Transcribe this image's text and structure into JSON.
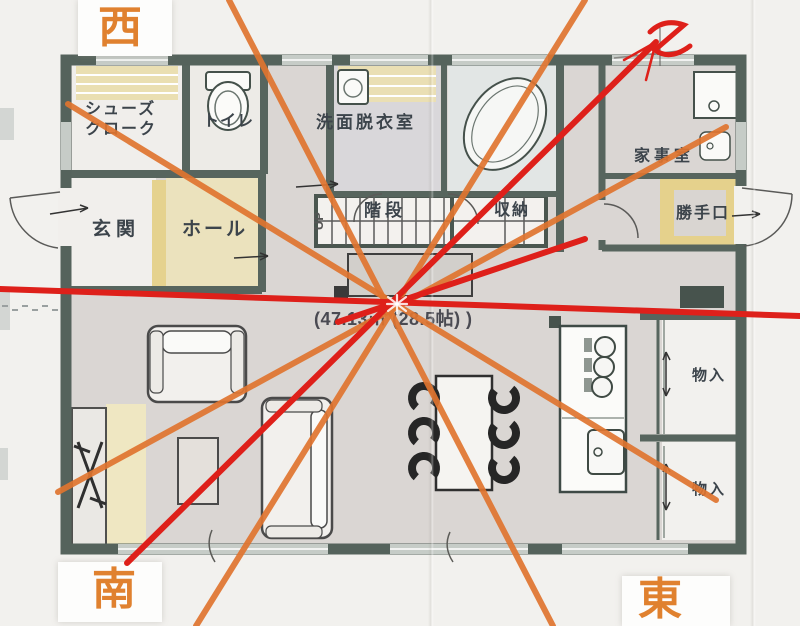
{
  "compass": {
    "west": "西",
    "south": "南",
    "east": "東"
  },
  "icons": {
    "north_mark": "handwritten-Z-north-arrow"
  },
  "rooms": {
    "shoes_closet_line1": "シューズ",
    "shoes_closet_line2": "クローク",
    "toilet": "トイレ",
    "washroom": "洗面脱衣室",
    "utility_room": "家事室",
    "back_door": "勝手口",
    "entrance": "玄関",
    "hall": "ホール",
    "stairs": "階段",
    "stairs_direction": "UP",
    "stairs_storage": "収納",
    "closet_upper": "物入",
    "closet_lower": "物入"
  },
  "ldk": {
    "area_text": "(47.13㎡ (28.5帖) )"
  },
  "colors": {
    "orange_line": "#e0742f",
    "red_line": "#de201a",
    "compass_text": "#e0812f",
    "wall": "#57655e"
  }
}
